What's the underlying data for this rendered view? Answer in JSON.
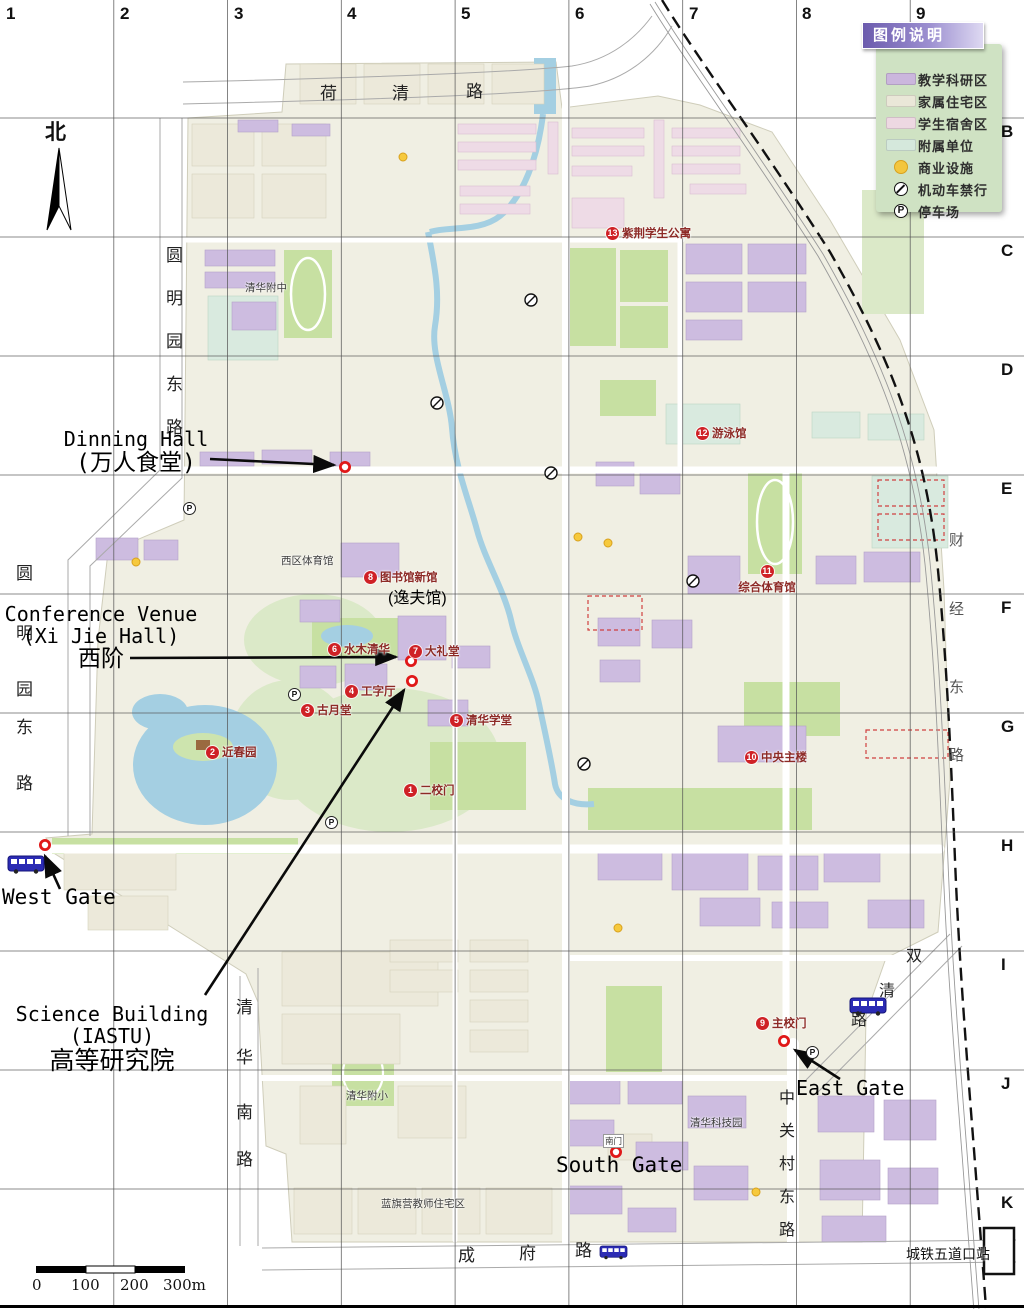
{
  "grid": {
    "cols": [
      "1",
      "2",
      "3",
      "4",
      "5",
      "6",
      "7",
      "8",
      "9"
    ],
    "rows": [
      "B",
      "C",
      "D",
      "E",
      "F",
      "G",
      "H",
      "I",
      "J",
      "K"
    ]
  },
  "compass": {
    "north": "北"
  },
  "legend": {
    "title": "图例说明",
    "items": [
      {
        "label": "教学科研区",
        "swatch": "#cbb6dd"
      },
      {
        "label": "家属住宅区",
        "swatch": "#eae7d8"
      },
      {
        "label": "学生宿舍区",
        "swatch": "#edd8e2"
      },
      {
        "label": "附属单位",
        "swatch": "#d5e8dc"
      },
      {
        "label": "商业设施",
        "swatch": "#f3c63e"
      },
      {
        "label": "机动车禁行",
        "icon": "no-entry"
      },
      {
        "label": "停车场",
        "icon": "parking"
      }
    ]
  },
  "icons": {
    "parking_glyph": "P"
  },
  "streets": {
    "heqing": "荷清路",
    "yuanmingyuan_east": "圆明园东路",
    "qinghua_south": "清华南路",
    "chengfu": "成府路",
    "zhongguancun_east": "中关村东路",
    "shuangqing": "双清路",
    "caijing_east": "财经东路"
  },
  "landmarks": [
    {
      "num": "1",
      "label": "二校门"
    },
    {
      "num": "2",
      "label": "近春园"
    },
    {
      "num": "3",
      "label": "古月堂"
    },
    {
      "num": "4",
      "label": "工字厅"
    },
    {
      "num": "5",
      "label": "清华学堂"
    },
    {
      "num": "6",
      "label": "水木清华"
    },
    {
      "num": "7",
      "label": "大礼堂"
    },
    {
      "num": "8",
      "label": "图书馆新馆",
      "sub": "(逸夫馆)"
    },
    {
      "num": "9",
      "label": "主校门"
    },
    {
      "num": "10",
      "label": "中央主楼"
    },
    {
      "num": "11",
      "label": "综合体育馆"
    },
    {
      "num": "12",
      "label": "游泳馆"
    },
    {
      "num": "13",
      "label": "紫荆学生公寓"
    }
  ],
  "places": {
    "affiliated_high_school": "清华附中",
    "west_gym": "西区体育馆",
    "affiliated_primary": "清华附小",
    "science_park": "清华科技园",
    "lanqiying": "蓝旗营教师住宅区",
    "subway_station": "城铁五道口站",
    "south_gate_small": "南门"
  },
  "annotations": {
    "dining": {
      "line1": "Dinning Hall",
      "line2": "(万人食堂)"
    },
    "conference": {
      "line1": "Conference Venue",
      "line2": "(Xi Jie Hall)",
      "line3": "西阶"
    },
    "west_gate": "West Gate",
    "science": {
      "line1": "Science Building",
      "line2": "(IASTU)",
      "line3": "高等研究院"
    },
    "east_gate": "East Gate",
    "south_gate": "South Gate"
  },
  "scalebar": {
    "t0": "0",
    "t1": "100",
    "t2": "200",
    "t3": "300m"
  },
  "colors": {
    "marker_red": "#cf2126",
    "poi_ring_red": "#e01818",
    "water": "#a4cfe2",
    "green": "#c7e0a2",
    "teaching_purple": "#cbb6dd",
    "housing_beige": "#eae7d8",
    "dorm_pink": "#edd8e2",
    "affiliated_mint": "#d5e8dc",
    "commerce_yellow": "#f3c63e",
    "legend_panel_green": "#cfe2c3",
    "legend_header_purple": "#6b5bad",
    "bus_blue": "#2b2bb4"
  }
}
